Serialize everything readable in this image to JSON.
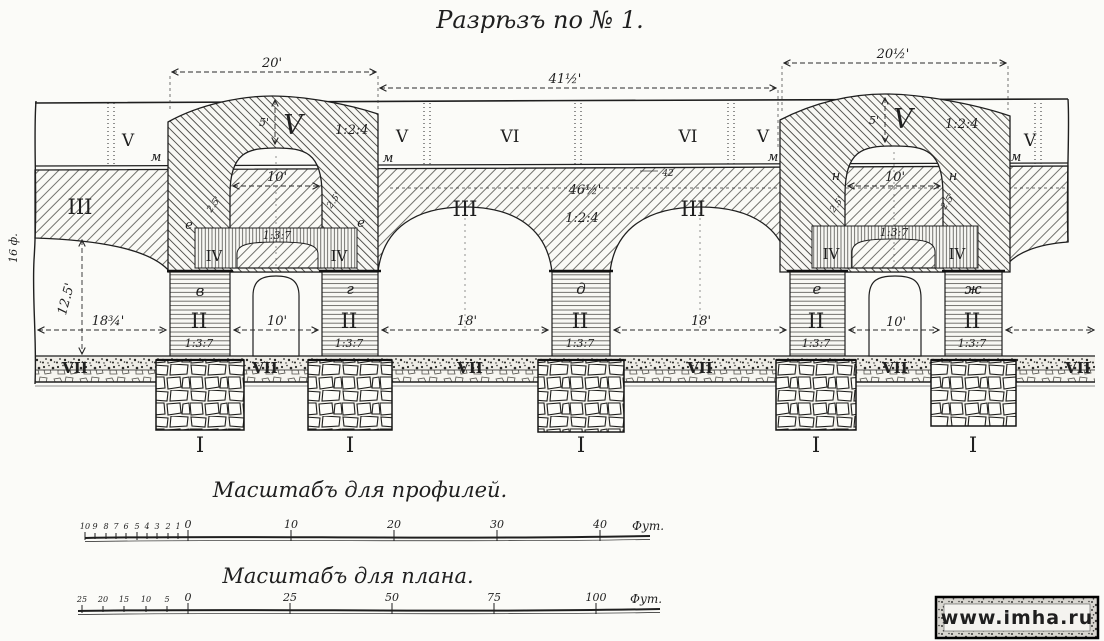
{
  "title": "Разрѣзъ по № 1.",
  "colors": {
    "paper": "#fbfbf8",
    "ink": "#1f1f1f"
  },
  "top_dims": {
    "left": "20'",
    "middle": "41½'",
    "right": "20½'"
  },
  "roof": {
    "labels": [
      "V",
      "V",
      "VI",
      "VI",
      "V",
      "V"
    ]
  },
  "mass": {
    "numeral_left": "III",
    "numeral_center": "III",
    "numeral_right": "III",
    "span_dim": "46½'",
    "ratio": "1:2:4",
    "note": "42"
  },
  "traverse_left": {
    "numeral": "V",
    "ratio": "1:2:4",
    "crown_dim": "5'",
    "door_dim": "10'",
    "jamb_dim_left": "2.5'",
    "jamb_dim_right": "2.5'",
    "point_left": "м",
    "point_right": "м",
    "corner_left": "е",
    "corner_right": "е",
    "band": {
      "numeral_left": "IV",
      "numeral_right": "IV",
      "ratio": "1:3:7"
    }
  },
  "traverse_right": {
    "numeral": "V",
    "ratio": "1:2:4",
    "crown_dim": "5'",
    "door_dim": "10'",
    "jamb_dim_left": "2.5'",
    "jamb_dim_right": "2.5'",
    "point_left": "м",
    "point_right": "м",
    "spring_left": "н",
    "spring_right": "н",
    "band": {
      "numeral_left": "IV",
      "numeral_right": "IV",
      "ratio": "1:3:7"
    }
  },
  "piers": [
    {
      "letter": "в",
      "numeral": "II",
      "ratio": "1:3:7"
    },
    {
      "letter": "г",
      "numeral": "II",
      "ratio": "1:3:7"
    },
    {
      "letter": "д",
      "numeral": "II",
      "ratio": "1:3:7"
    },
    {
      "letter": "е",
      "numeral": "II",
      "ratio": "1:3:7"
    },
    {
      "letter": "ж",
      "numeral": "II",
      "ratio": "1:3:7"
    }
  ],
  "bay_dims": {
    "left": "18¾'",
    "door_left": "10'",
    "mid1": "18'",
    "mid2": "18'",
    "door_right": "10'"
  },
  "vertical_dims": {
    "pier_height": "12.5'",
    "edge_height": "16 ф."
  },
  "ground": {
    "labels": [
      "VII",
      "VII",
      "VII",
      "VII",
      "VII",
      "VII"
    ]
  },
  "foundations": {
    "labels": [
      "I",
      "I",
      "I",
      "I",
      "I"
    ]
  },
  "scales": {
    "profile": {
      "title": "Масштабъ для профилей.",
      "sub_ticks": [
        "10",
        "9",
        "8",
        "7",
        "6",
        "5",
        "4",
        "3",
        "2",
        "1",
        "0"
      ],
      "main_ticks": [
        "10",
        "20",
        "30",
        "40"
      ],
      "unit": "Фут."
    },
    "plan": {
      "title": "Масштабъ для плана.",
      "sub_ticks": [
        "25",
        "20",
        "15",
        "10",
        "5",
        "0"
      ],
      "main_ticks": [
        "25",
        "50",
        "75",
        "100"
      ],
      "unit": "Фут."
    }
  },
  "watermark": {
    "text": "www.imha.ru"
  }
}
